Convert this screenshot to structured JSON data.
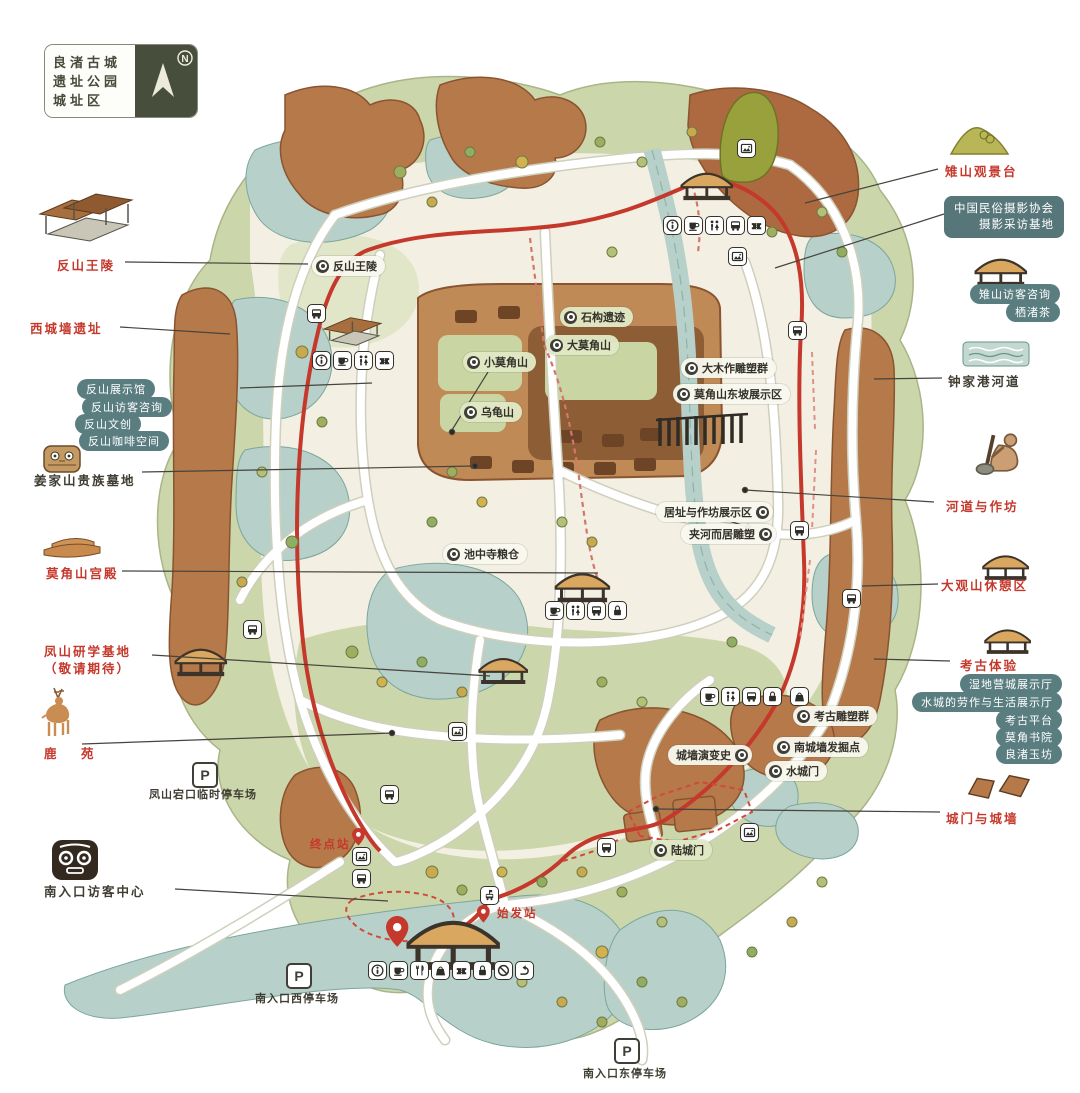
{
  "title_box": {
    "lines": [
      "良渚古城",
      "遗址公园",
      "城址区"
    ],
    "north_label": "N"
  },
  "left_column": {
    "fanshan_tomb": "反山王陵",
    "west_wall_site": "西城墙遗址",
    "fanshan_pills": [
      "反山展示馆",
      "反山访客咨询",
      "反山文创",
      "反山咖啡空间"
    ],
    "jiangjiashan_cemetery": "姜家山贵族墓地",
    "mojiaoshan_palace": "莫角山宫殿",
    "fengshan_base_line1": "凤山研学基地",
    "fengshan_base_line2": "（敬请期待）",
    "deer_garden": "鹿　苑",
    "south_visitor_center": "南入口访客中心"
  },
  "right_column": {
    "zhishan_viewpoint": "雉山观景台",
    "photo_assoc_line1": "中国民俗摄影协会",
    "photo_assoc_line2": "摄影采访基地",
    "zhishan_pills": [
      "雉山访客咨询",
      "栖渚茶"
    ],
    "zhongjiagang_river": "钟家港河道",
    "river_and_workshop": "河道与作坊",
    "daguanshan_rest_area": "大观山休憩区",
    "archaeology_experience": "考古体验",
    "daguanshan_pills": [
      "湿地营城展示厅",
      "水城的劳作与生活展示厅",
      "考古平台",
      "莫角书院",
      "良渚玉坊"
    ],
    "gates_and_walls": "城门与城墙"
  },
  "map_labels": {
    "fanshan_tomb": "反山王陵",
    "stone_remains": "石构遗迹",
    "da_mojiaoshan": "大莫角山",
    "xiao_mojiaoshan": "小莫角山",
    "wuguishan": "乌龟山",
    "timberwork_sculptures": "大木作雕塑群",
    "east_slope_area": "莫角山东坡展示区",
    "dwelling_workshop_area": "居址与作坊展示区",
    "riverside_sculpture": "夹河而居雕塑",
    "chizhongsi_granary": "池中寺粮仓",
    "archaeology_sculptures": "考古雕塑群",
    "south_wall_excavation": "南城墙发掘点",
    "wall_evolution": "城墙演变史",
    "water_gate": "水城门",
    "land_gate": "陆城门"
  },
  "stations": {
    "terminal": "终点站",
    "departure": "始发站"
  },
  "parking": {
    "symbol": "P",
    "fengshan": "凤山宕口临时停车场",
    "south_west": "南入口西停车场",
    "south_east": "南入口东停车场"
  },
  "icon_clusters": {
    "north_gate": [
      "info",
      "cafe",
      "restroom",
      "bus",
      "ticket"
    ],
    "fanshan": [
      "info",
      "cafe",
      "restroom",
      "ticket"
    ],
    "daguanshan": [
      "cafe",
      "restroom",
      "bus",
      "locker"
    ],
    "southeast": [
      "cafe",
      "restroom",
      "bus",
      "locker",
      "shop"
    ],
    "south_entrance": [
      "info",
      "cafe",
      "restaurant",
      "shop",
      "ticket",
      "locker",
      "no-smoking",
      "exit"
    ]
  },
  "colors": {
    "accent_red": "#c5392c",
    "teal_pill": "#5a7d80",
    "dark": "#3f3f38",
    "land_green": "#ccd6ab",
    "water": "#b7d0c9",
    "wall_brown": "#b5794a",
    "inner_cream": "#f3f0e3",
    "title_green": "#474f3c"
  }
}
